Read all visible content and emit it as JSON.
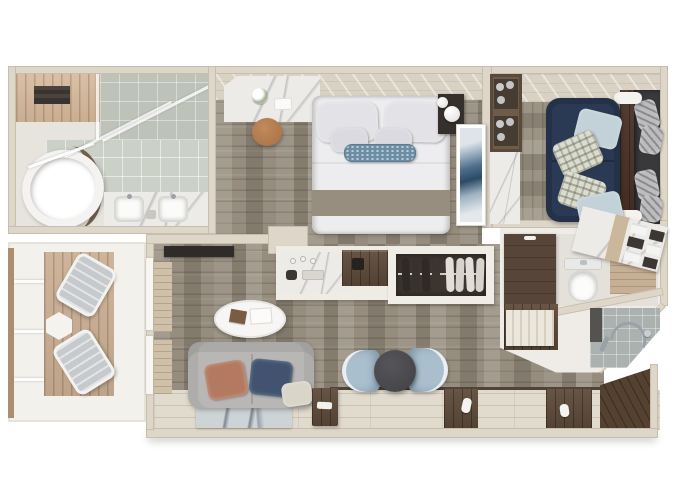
{
  "scene": {
    "title": "Top-down 3D floor plan rendering of a one-bedroom balcony suite",
    "type": "3d-floor-plan",
    "view": "top-down",
    "text_on_image": ""
  },
  "palette": {
    "wall": "#ded6c8",
    "wall-edge": "#c7bfae",
    "slab": "#f3f1ec",
    "carpet": "#968d7e",
    "carpet-sitting": "#9b9384",
    "deck": "#c9ae92",
    "wood-light": "#e1dbce",
    "wood-dark": "#5e4a3a",
    "wood-entry": "#54412f",
    "marble": "#edebe7",
    "tile": "#bec3ba",
    "tile-shower": "#abb1af",
    "bed-white": "#ededef",
    "runner-taupe": "#988e7f",
    "accent-blue": "#6b8ea4",
    "navy-sofa": "#2a3a54",
    "chair-blue": "#aabfcd",
    "table-dark": "#47474b",
    "sofa-gray": "#b8b7b5",
    "terracotta": "#b37a61",
    "pillow-navy": "#41536e",
    "stool-tan": "#ad764b",
    "art-blue": "#4f6f8d",
    "chrome": "#9aa2a8",
    "wardrobe-brown": "#57453a",
    "tv-black": "#2e2b28"
  },
  "rooms": {
    "master_bathroom": {
      "name": "master bathroom",
      "features": [
        "oval bathtub",
        "double-sink marble vanity",
        "glass shower partition",
        "tiled floor",
        "ceiling vent"
      ]
    },
    "bedroom": {
      "name": "bedroom",
      "features": [
        "double bed with white duvet",
        "taupe bed runner",
        "blue accent pillow",
        "marble vanity desk",
        "round tan stool",
        "nightstand with globe lamps",
        "abstract blue wall art",
        "wood headboard wall"
      ]
    },
    "sitting_room": {
      "name": "sitting room",
      "features": [
        "navy sofa",
        "patterned accent pillows",
        "glassware shelving",
        "window chaise with gray pillows",
        "dark wood console"
      ]
    },
    "living_area": {
      "name": "living area",
      "features": [
        "gray loveseat",
        "terracotta pillow",
        "navy pillow",
        "oval coffee table with books",
        "abstract area rug",
        "wall-mounted tv",
        "window bench",
        "dark wood side table"
      ]
    },
    "dining_nook": {
      "name": "dining nook",
      "features": [
        "two light-blue tub chairs",
        "round charcoal table"
      ]
    },
    "minibar": {
      "name": "minibar counter",
      "features": [
        "marble top",
        "glassware",
        "dark wood hutch"
      ]
    },
    "walk_in_closet": {
      "name": "walk-in closet",
      "features": [
        "hanging rail",
        "garments on hangers"
      ]
    },
    "guest_bathroom": {
      "name": "guest bathroom",
      "features": [
        "toilet",
        "marble towel shelf",
        "wood wall panel",
        "shower with chrome fixtures",
        "dark wardrobe",
        "slatted cabinet"
      ]
    },
    "balcony": {
      "name": "balcony",
      "features": [
        "wood deck",
        "two loungers",
        "hexagonal side table",
        "railing"
      ]
    },
    "entry": {
      "name": "entry corridor",
      "features": [
        "whitewashed wood floor",
        "dark wood runners",
        "slippers"
      ]
    }
  }
}
